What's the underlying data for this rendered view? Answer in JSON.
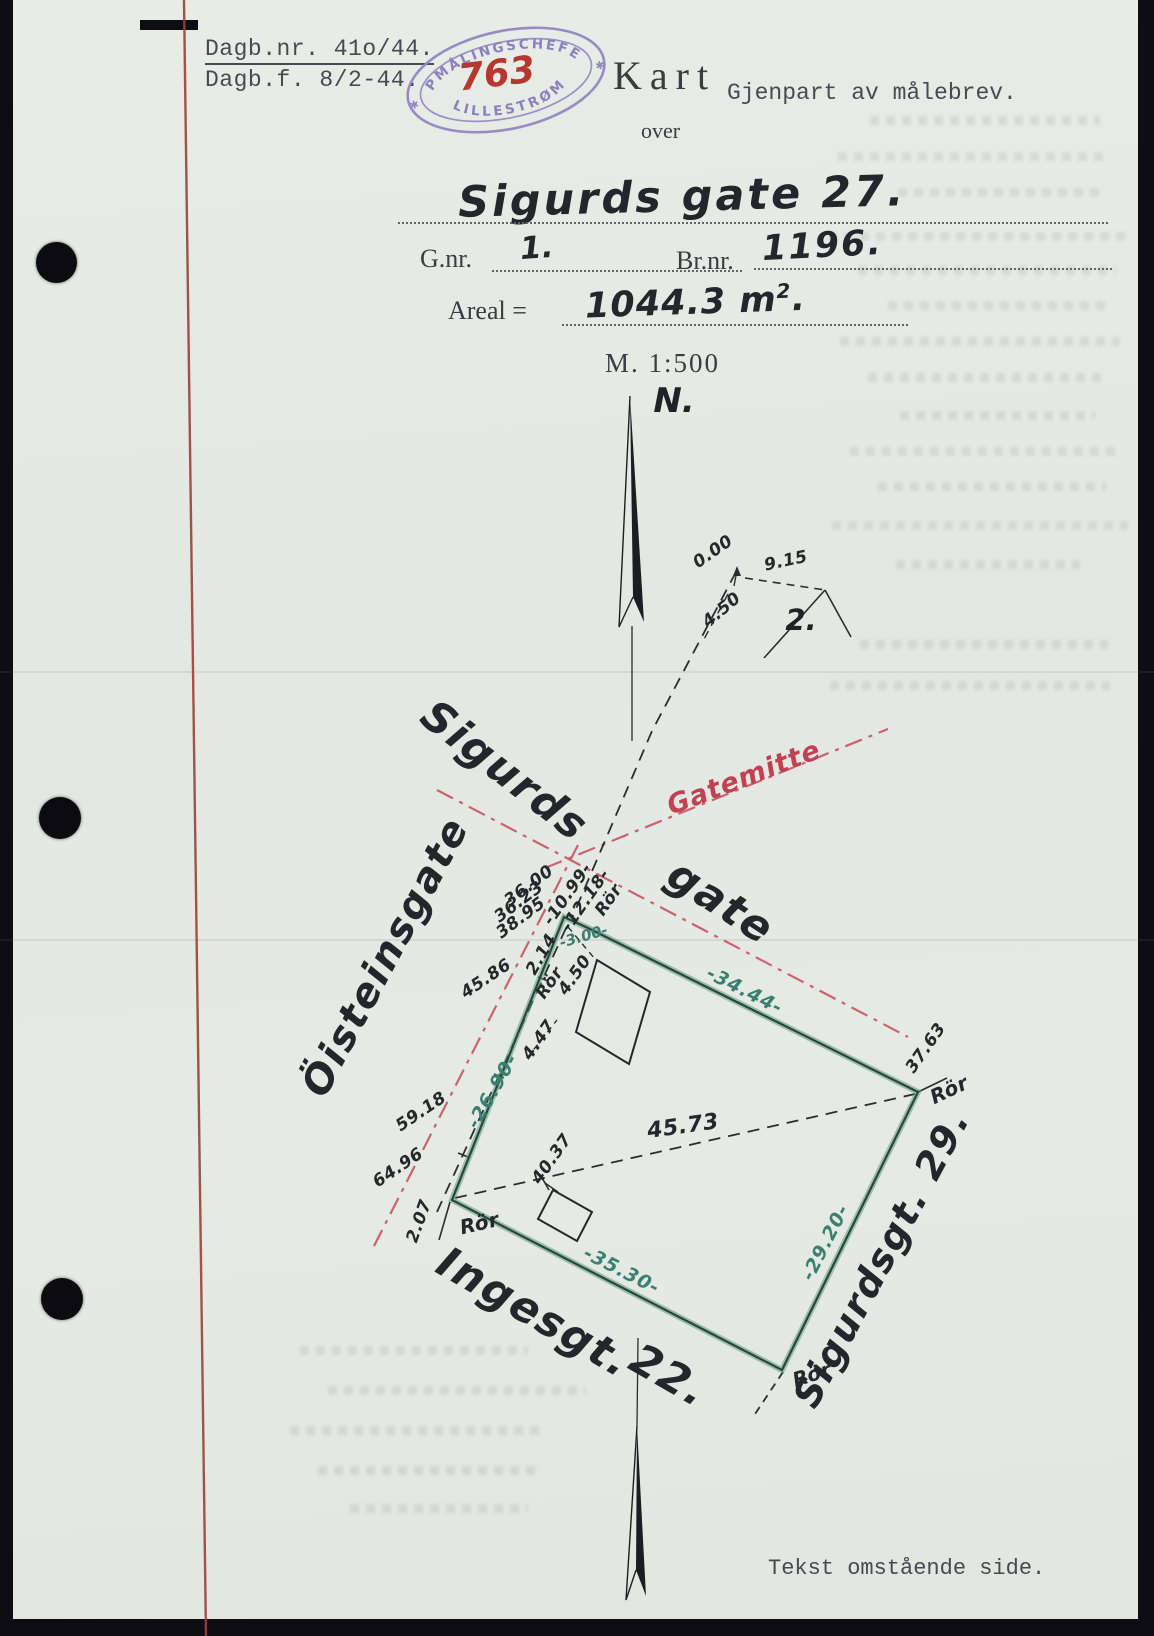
{
  "document": {
    "registry": {
      "line1": "Dagb.nr. 41o/44.",
      "line2": "Dagb.f. 8/2-44."
    },
    "stamp": {
      "arc_top": "OPMÅLINGSCHEFEN",
      "arc_bottom": "LILLESTRØM",
      "number": "763",
      "star": "✱"
    },
    "title": {
      "main": "Kart",
      "copy_note": "Gjenpart av målebrev.",
      "preposition": "over"
    },
    "property": {
      "street_name": "Sigurds gate 27.",
      "gnr_label": "G.nr.",
      "gnr_value": "1.",
      "brnr_label": "Br.nr.",
      "brnr_value": "1196.",
      "area_label": "Areal =",
      "area_value": "1044.3 m",
      "area_exponent": "2",
      "area_period": ".",
      "scale": "M. 1:500"
    },
    "footer_note": "Tekst omstående side."
  },
  "map": {
    "north_label": "N.",
    "marker": "Rör",
    "streets": {
      "sigurds": "Sigurds",
      "gate": "gate",
      "gatemitte": "Gatemitte",
      "oisteinsgate": "Öisteinsgate",
      "ingesgate": "Ingesgt.",
      "ingesgate_number": "22.",
      "neighbor": "Sigurdsgt. 29."
    },
    "parcel2": {
      "label": "2.",
      "d_zero": "0.00",
      "d_915": "9.15",
      "d_450": "4.50"
    },
    "boundary": {
      "side_nw": "-26.90-",
      "side_ne": "-34.44-",
      "side_se": "-29.20-",
      "side_sw": "-35.30-",
      "corner_cut": "-3.00-"
    },
    "measures": {
      "m3600": "36.00",
      "m3623": "36.23",
      "m3895": "38.95",
      "m1099": "-10.99-",
      "m1218": "-12.18-",
      "m214": "2.14",
      "m450": "4.50",
      "m447": "4.47",
      "m4586": "45.86",
      "m5918": "59.18",
      "m6496": "64.96",
      "m207": "2.07",
      "m4037": "40.37",
      "m4573": "45.73",
      "m3763": "37.63"
    }
  }
}
